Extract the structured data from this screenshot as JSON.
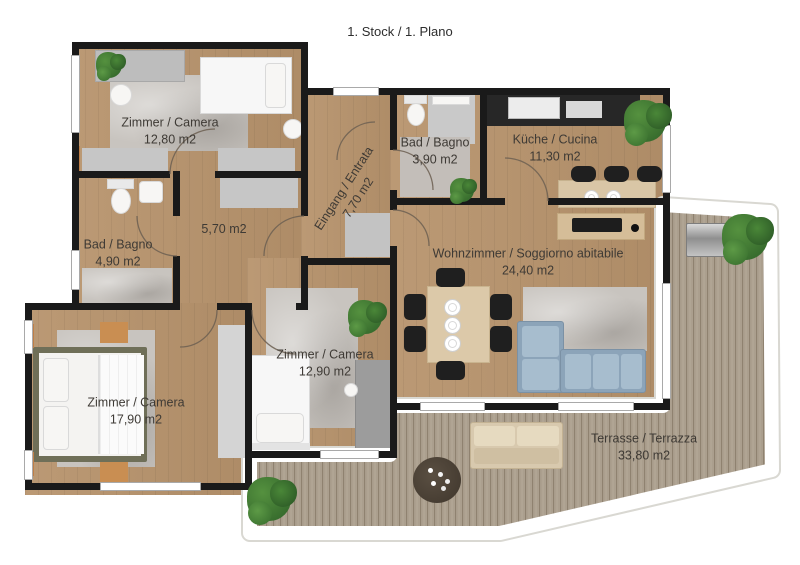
{
  "title": "1. Stock / 1. Plano",
  "rooms": [
    {
      "id": "zimmer-nw",
      "name": "Zimmer / Camera",
      "area": "12,80 m2"
    },
    {
      "id": "bad-nord",
      "name": "Bad / Bagno",
      "area": "3,90 m2"
    },
    {
      "id": "kueche",
      "name": "Küche / Cucina",
      "area": "11,30 m2"
    },
    {
      "id": "eingang",
      "name": "Eingang / Entrata",
      "area": "7,70 m2"
    },
    {
      "id": "flur",
      "name": "",
      "area": "5,70 m2"
    },
    {
      "id": "bad-west",
      "name": "Bad / Bagno",
      "area": "4,90 m2"
    },
    {
      "id": "wohnzimmer",
      "name": "Wohnzimmer / Soggiorno abitabile",
      "area": "24,40 m2"
    },
    {
      "id": "zimmer-mitte",
      "name": "Zimmer / Camera",
      "area": "12,90 m2"
    },
    {
      "id": "zimmer-sw",
      "name": "Zimmer / Camera",
      "area": "17,90 m2"
    },
    {
      "id": "terrasse",
      "name": "Terrasse / Terrazza",
      "area": "33,80 m2"
    }
  ],
  "colors": {
    "wall": "#1a1a1a",
    "wood_floor": "#b7936c",
    "terrace_deck": "#aca08f",
    "rug": "#c8c4bf",
    "sofa_blue": "#8ca4b9",
    "plant_green": "#3c7a33",
    "counter_dark": "#272727"
  }
}
